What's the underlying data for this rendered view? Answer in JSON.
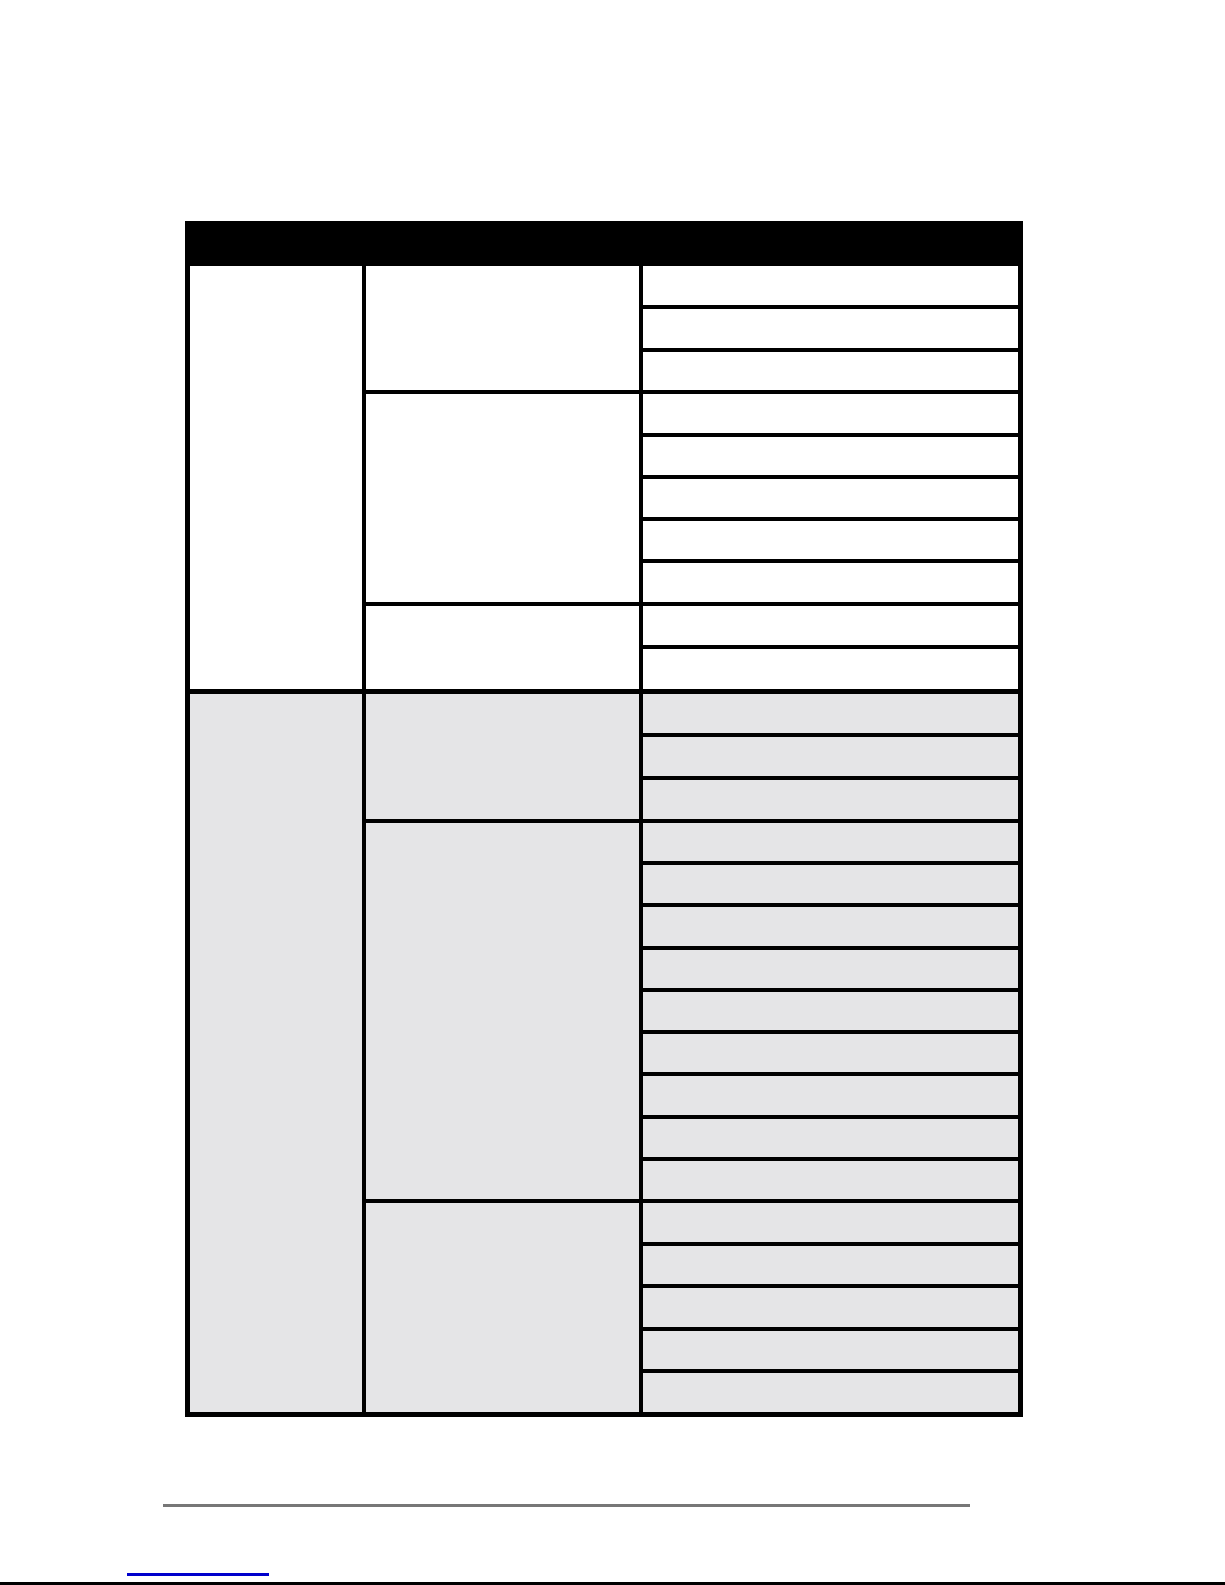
{
  "page": {
    "background": "#ffffff"
  },
  "table": {
    "grid_color": "#000000",
    "header": {
      "label": "",
      "background": "#000000"
    },
    "columns": 3,
    "all_cells_empty": true,
    "sections": [
      {
        "name": "upper",
        "background": "#ffffff",
        "groups": [
          {
            "rows": 3
          },
          {
            "rows": 5
          },
          {
            "rows": 2
          }
        ]
      },
      {
        "name": "lower",
        "background": "#e5e5e7",
        "groups": [
          {
            "rows": 3
          },
          {
            "rows": 9
          },
          {
            "rows": 5
          }
        ]
      }
    ]
  },
  "footer": {
    "rule_color": "#777777",
    "link": {
      "label": "",
      "underline_color": "#0000cc"
    },
    "bottom_edge_color": "#000000"
  }
}
